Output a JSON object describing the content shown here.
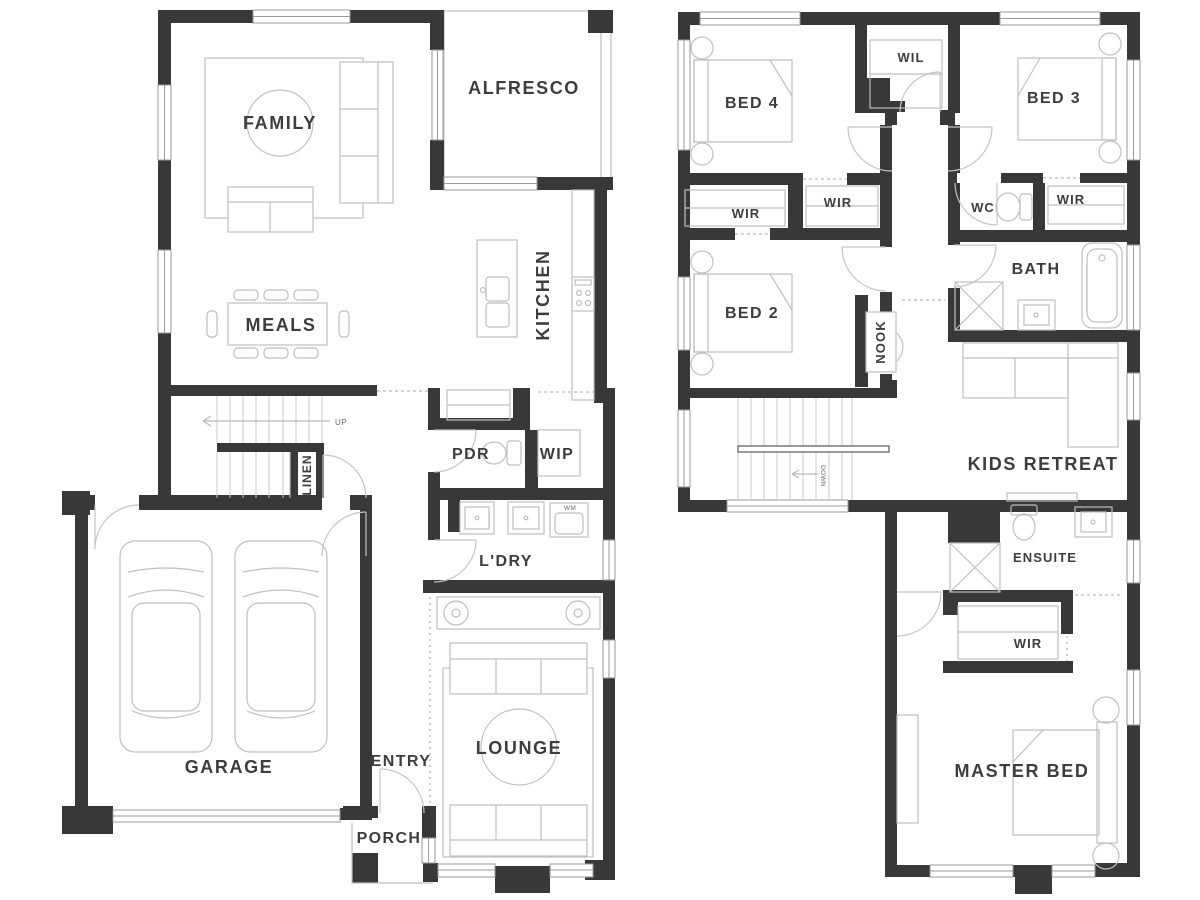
{
  "meta": {
    "type": "residential floor plan",
    "floors": 2
  },
  "colors": {
    "wall": "#383838",
    "furniture": "#bfbfbf",
    "label": "#3d3d3d",
    "window": "#9a9a9a"
  },
  "ground_floor": {
    "family": "FAMILY",
    "alfresco": "ALFRESCO",
    "kitchen": "KITCHEN",
    "meals": "MEALS",
    "up": "UP",
    "linen": "LINEN",
    "pdr": "PDR",
    "wip": "WIP",
    "laundry": "L'DRY",
    "wm": "WM",
    "garage": "GARAGE",
    "entry": "ENTRY",
    "porch": "PORCH",
    "lounge": "LOUNGE"
  },
  "first_floor": {
    "bed4": "BED 4",
    "wil": "WIL",
    "bed3": "BED 3",
    "wir_bed4": "WIR",
    "wir_hall": "WIR",
    "wc": "WC",
    "wir_bed3": "WIR",
    "bed2": "BED 2",
    "bath": "BATH",
    "nook": "NOOK",
    "down": "DOWN",
    "kids_retreat": "KIDS RETREAT",
    "ensuite": "ENSUITE",
    "wir_master": "WIR",
    "master_bed": "MASTER BED"
  }
}
